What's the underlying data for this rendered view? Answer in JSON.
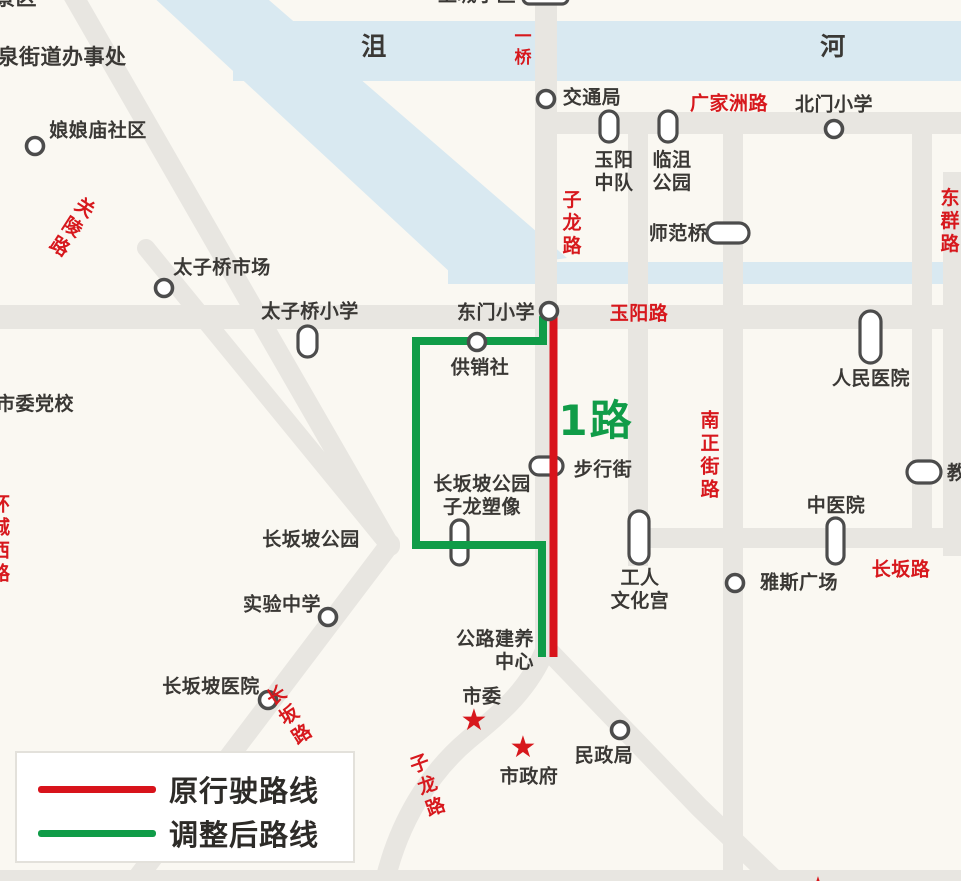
{
  "colors": {
    "bg": "#faf8f2",
    "road": "#e8e6e1",
    "river": "#d9e9f1",
    "red": "#d8131b",
    "green": "#109c48",
    "red-label": "#d7181d",
    "ink": "#3a3835",
    "marker": "#4c4c4c"
  },
  "legend": {
    "original_route": "原行驶路线",
    "adjusted_route": "调整后路线"
  },
  "labels": {
    "scenic_area": "景区",
    "yuquan_office": "玉泉街道办事处",
    "river_ju": "沮",
    "river_he": "河",
    "yiqiao_bridge": "一桥",
    "shangcheng": "上城小区",
    "niangniangmiao": "娘娘庙社区",
    "guanling_road": "关陵路",
    "taiziqiao_market": "太子桥市场",
    "taiziqiao_school": "太子桥小学",
    "jiaotongju": "交通局",
    "guangjiazhou_road": "广家洲路",
    "beimen_school": "北门小学",
    "yuyang_zhongdui": "玉阳\n中队",
    "linju_park": "临沮\n公园",
    "zilong_road_top": "子龙路",
    "shifan_bridge": "师范桥",
    "dongqun_road": "东群路",
    "shiwei_dangxiao": "市委党校",
    "dongmen_school": "东门小学",
    "yuyang_road": "玉阳路",
    "gongxiaoshe": "供销社",
    "renmin_hospital": "人民医院",
    "route_1": "1路",
    "nanzhengjie_road": "南正街路",
    "buxingjie": "步行街",
    "jiao_partial": "教",
    "changbanpo_statue": "长坂坡公园\n子龙塑像",
    "zhongyiyuan": "中医院",
    "changbanpo_park": "长坂坡公园",
    "changban_road_right": "长坂路",
    "yasi_square": "雅斯广场",
    "gongren_wenhuagong": "工人\n文化宫",
    "shiyan_school": "实验中学",
    "gonglu_center": "公路建养\n中心",
    "changbanpo_hospital": "长坂坡医院",
    "changban_road_diag": "长坂路",
    "shiwei": "市委",
    "minzhengju": "民政局",
    "shizhengfu": "市政府",
    "zilong_road_bottom": "子龙路",
    "huanchengxi_road": "环城西路",
    "star_glyph": "★"
  }
}
